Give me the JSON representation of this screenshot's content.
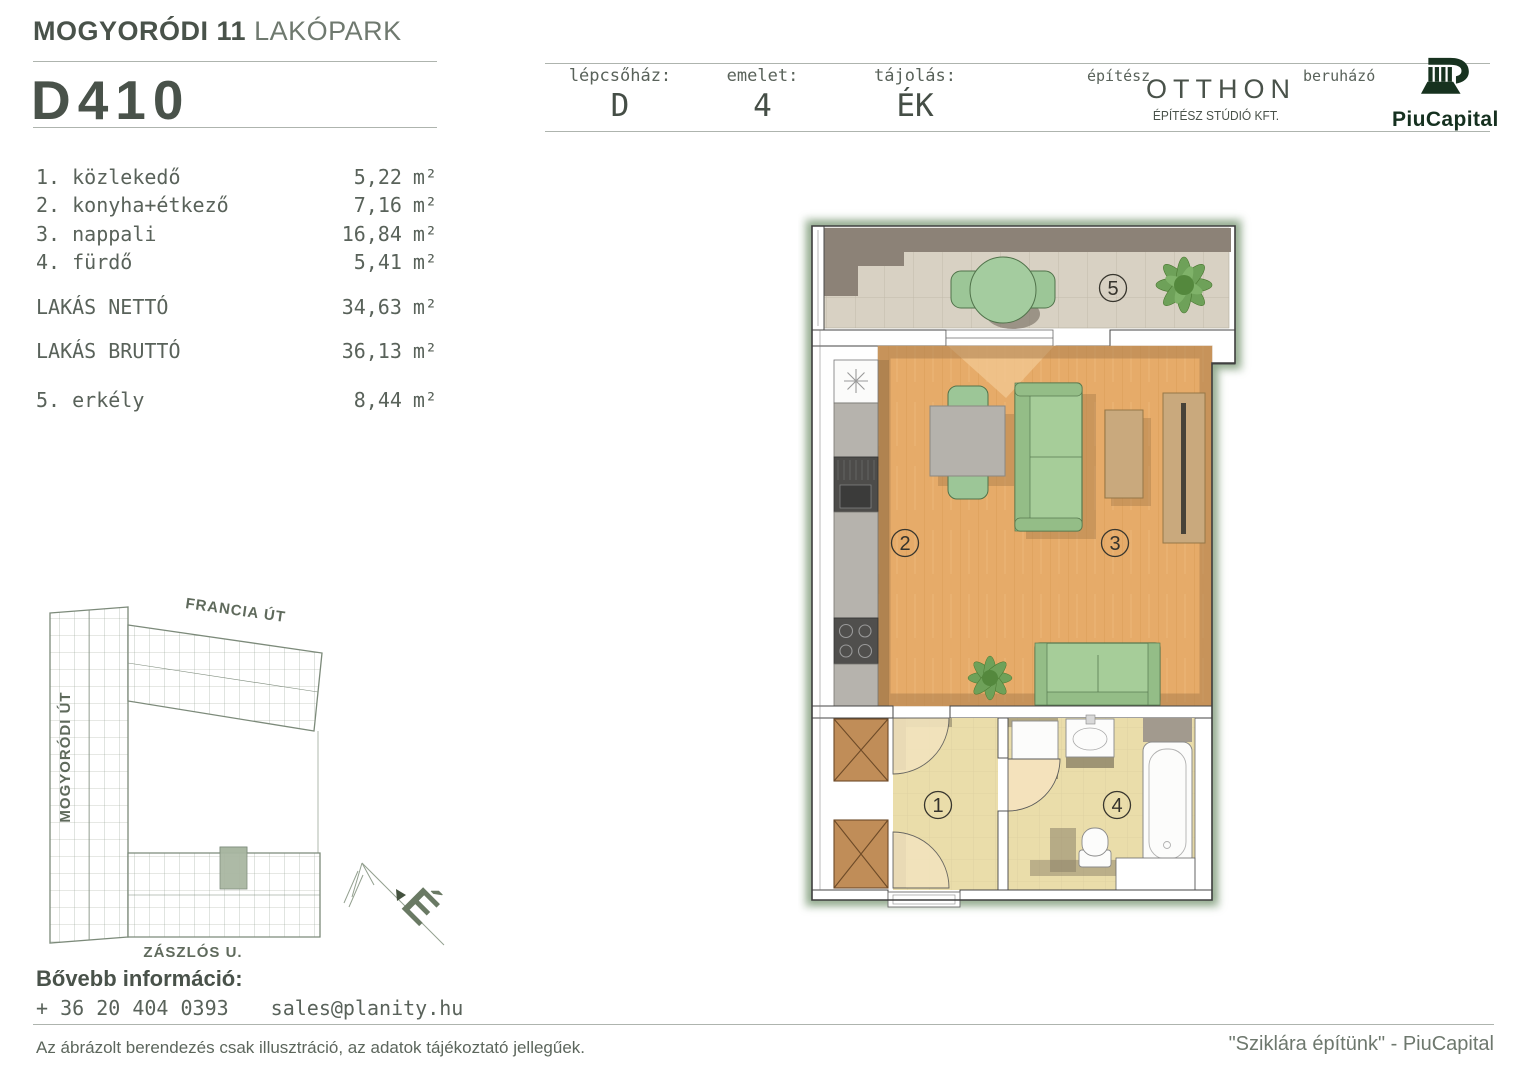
{
  "project": {
    "title_bold": "MOGYORÓDI 11",
    "title_light": "LAKÓPARK"
  },
  "unit": {
    "code": "D410"
  },
  "header_fields": [
    {
      "label": "lépcsőház:",
      "value": "D"
    },
    {
      "label": "emelet:",
      "value": "4"
    },
    {
      "label": "tájolás:",
      "value": "ÉK"
    }
  ],
  "branding": {
    "architect_label": "építész",
    "architect_name": "OTTHON",
    "architect_sub": "ÉPÍTÉSZ STÚDIÓ KFT.",
    "developer_label": "beruházó",
    "developer_name": "PiuCapital"
  },
  "room_list": {
    "rooms": [
      {
        "no": "1. ",
        "name": "közlekedő",
        "area": "5,22",
        "unit": "m²"
      },
      {
        "no": "2. ",
        "name": "konyha+étkező",
        "area": "7,16",
        "unit": "m²"
      },
      {
        "no": "3. ",
        "name": "nappali",
        "area": "16,84",
        "unit": "m²"
      },
      {
        "no": "4. ",
        "name": "fürdő",
        "area": "5,41",
        "unit": "m²"
      }
    ],
    "totals": [
      {
        "name": "LAKÁS NETTÓ",
        "area": "34,63",
        "unit": "m²"
      },
      {
        "name": "LAKÁS BRUTTÓ",
        "area": "36,13",
        "unit": "m²"
      }
    ],
    "outdoor": [
      {
        "no": "5. ",
        "name": "erkély",
        "area": "8,44",
        "unit": "m²"
      }
    ]
  },
  "floor_plan_labels": {
    "hall": "1",
    "kitchen": "2",
    "living": "3",
    "bath": "4",
    "balcony": "5"
  },
  "site_plan": {
    "street_top": "FRANCIA ÚT",
    "street_left": "MOGYORÓDI ÚT",
    "street_bottom": "ZÁSZLÓS U.",
    "compass": "É"
  },
  "contact": {
    "heading": "Bővebb információ:",
    "phone": "+ 36 20 404 0393",
    "email": "sales@planity.hu"
  },
  "footer": {
    "disclaimer": "Az ábrázolt berendezés csak illusztráció, az adatok tájékoztató jellegűek.",
    "slogan": "\"Sziklára építünk\" - PiuCapital"
  },
  "colors": {
    "ink": "#49524a",
    "accent_green": "#7d9a78",
    "logo_green": "#17321f"
  }
}
